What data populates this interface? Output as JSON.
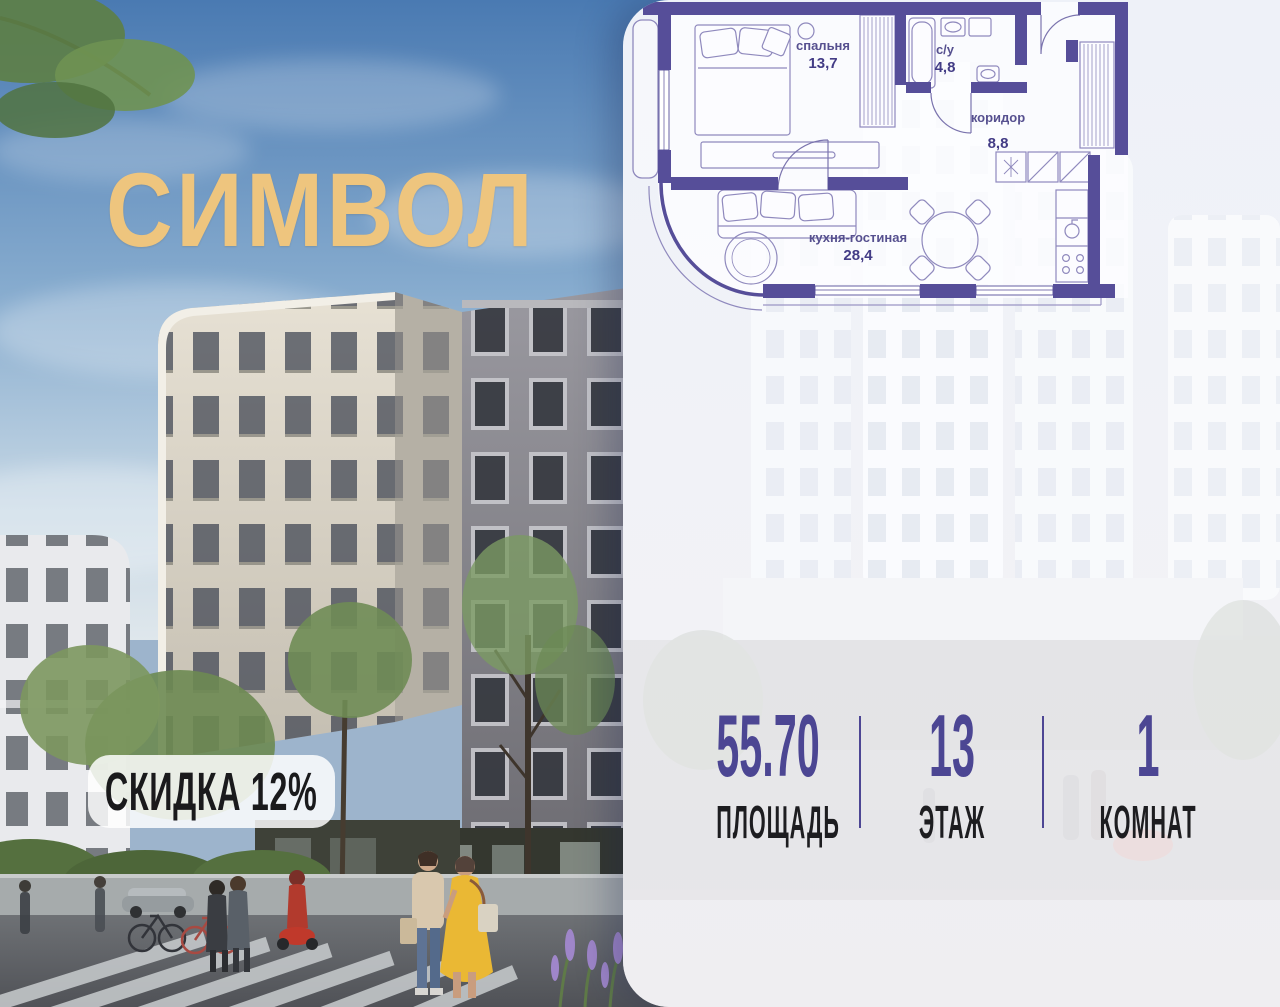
{
  "brand": {
    "logo": "СИМВОЛ",
    "logo_color": "#eec57e"
  },
  "discount_badge": {
    "label": "СКИДКА 12%"
  },
  "floor_plan": {
    "wall_color": "#564e99",
    "rooms": [
      {
        "name": "спальня",
        "area": "13,7"
      },
      {
        "name": "с/у",
        "area": "4,8"
      },
      {
        "name": "коридор",
        "area": "8,8"
      },
      {
        "name": "кухня-гостиная",
        "area": "28,4"
      }
    ]
  },
  "stats": {
    "accent_color": "#4c4693",
    "items": [
      {
        "value": "55.70",
        "label": "ПЛОЩАДЬ"
      },
      {
        "value": "13",
        "label": "ЭТАЖ"
      },
      {
        "value": "1",
        "label": "КОМНАТ"
      }
    ]
  }
}
